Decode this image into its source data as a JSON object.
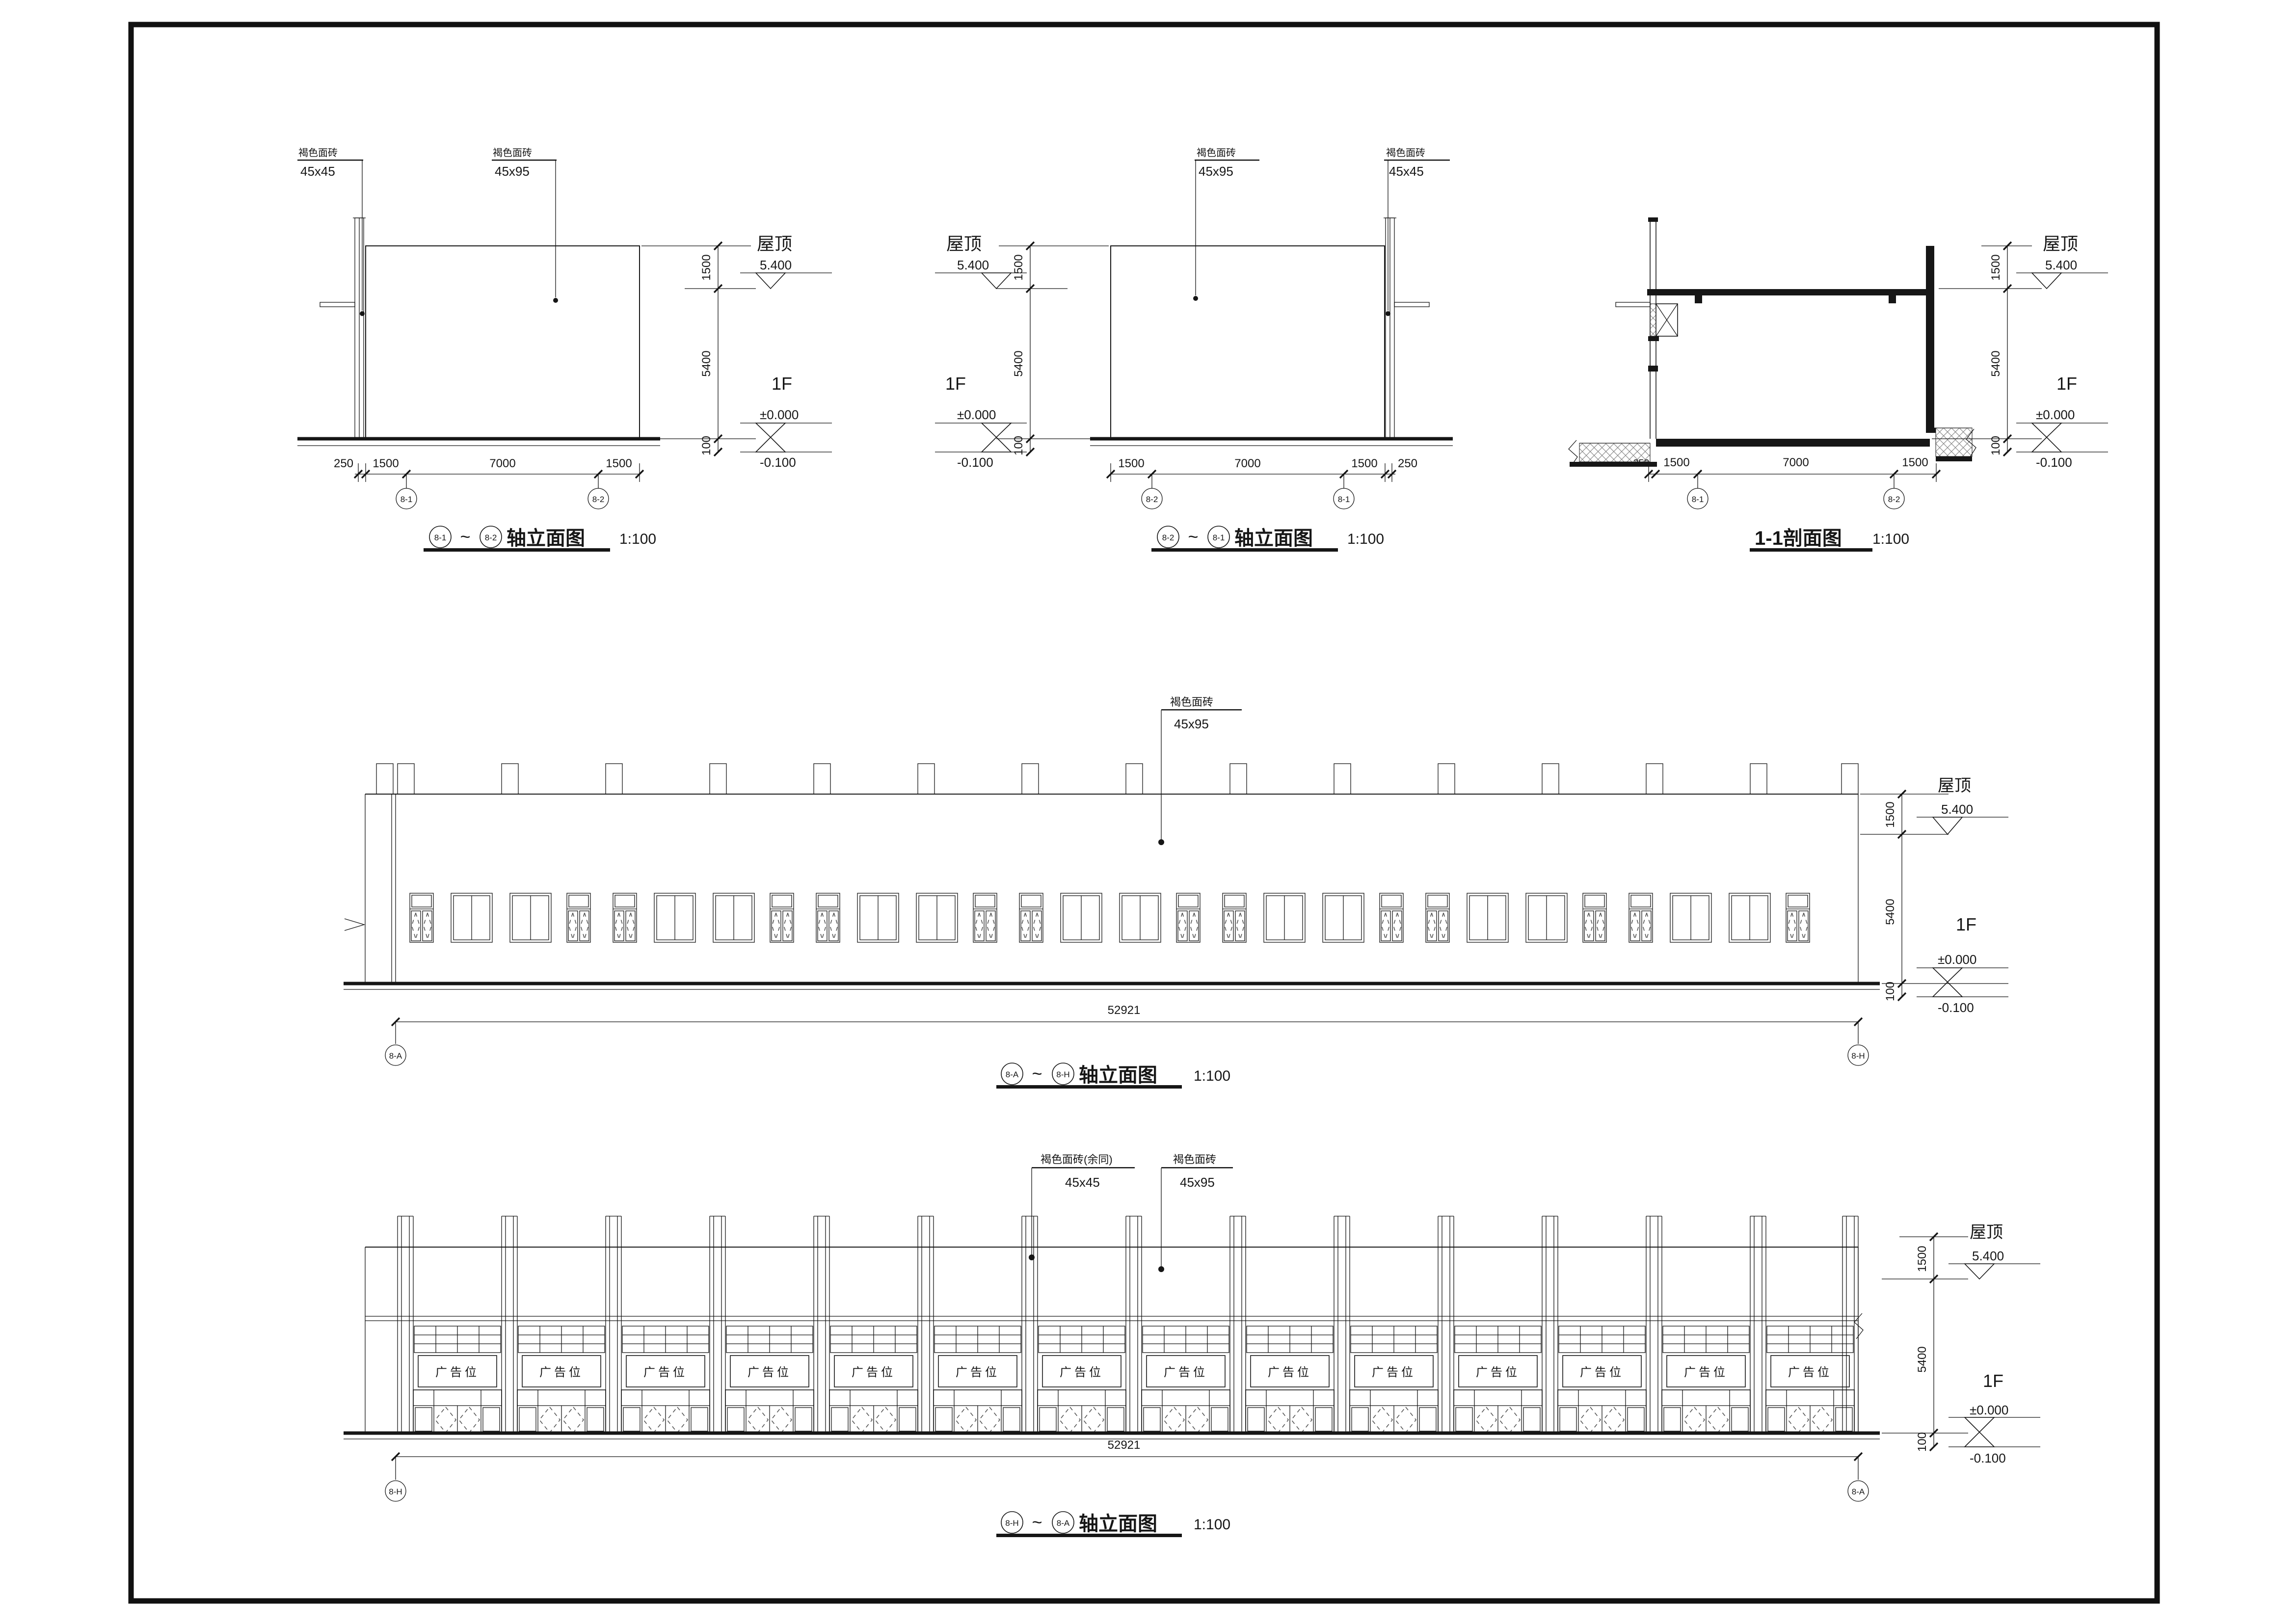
{
  "page": {
    "background": "#ffffff",
    "line_color": "#161616"
  },
  "materials": {
    "tile": "褐色面砖",
    "tile_rest": "褐色面砖(余同)",
    "size_small": "45x45",
    "size_large": "45x95"
  },
  "levels": {
    "roof_name": "屋顶",
    "roof_value": "5.400",
    "floor_name": "1F",
    "zero": "±0.000",
    "below": "-0.100",
    "band_height": "1500",
    "floor_height": "5400",
    "base_offset": "100"
  },
  "dims": {
    "d250": "250",
    "d1500": "1500",
    "d7000": "7000",
    "total_length": "52921"
  },
  "axes": {
    "a81": "8-1",
    "a82": "8-2",
    "aA": "8-A",
    "aH": "8-H"
  },
  "titles": {
    "elevation_suffix": "轴立面图",
    "section": "1-1剖面图",
    "scale": "1:100",
    "tilde": "~"
  },
  "ad_label": "广告位",
  "drawings": [
    {
      "id": "elev-8-1-to-8-2",
      "title": "(8-1)~(8-2)轴立面图",
      "scale": "1:100"
    },
    {
      "id": "elev-8-2-to-8-1",
      "title": "(8-2)~(8-1)轴立面图",
      "scale": "1:100"
    },
    {
      "id": "section-1-1",
      "title": "1-1剖面图",
      "scale": "1:100"
    },
    {
      "id": "elev-8-A-to-8-H",
      "title": "(8-A)~(8-H)轴立面图",
      "scale": "1:100"
    },
    {
      "id": "elev-8-H-to-8-A",
      "title": "(8-H)~(8-A)轴立面图",
      "scale": "1:100"
    }
  ]
}
